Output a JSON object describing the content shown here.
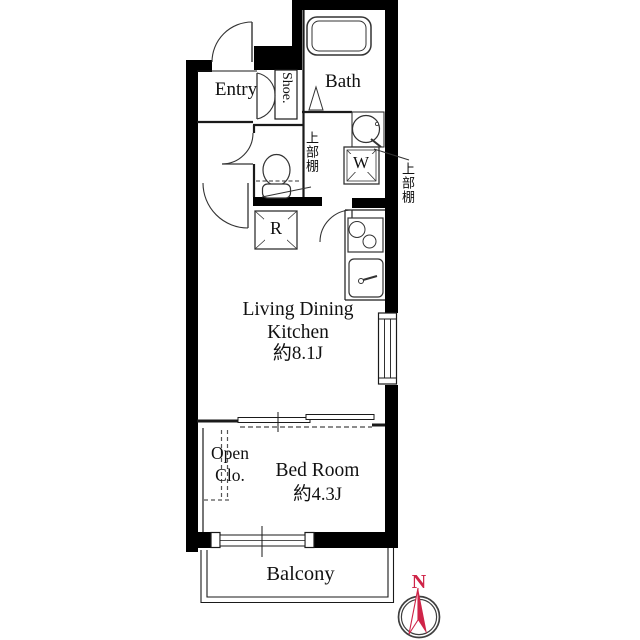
{
  "colors": {
    "wall": "#000000",
    "line": "#1a1a1a",
    "accent_red": "#cf2448"
  },
  "rooms": {
    "entry": {
      "label": "Entry"
    },
    "bath": {
      "label": "Bath"
    },
    "shoe": {
      "label": "Shoe."
    },
    "ldk": {
      "line1": "Living Dining",
      "line2": "Kitchen",
      "area": "約8.1J"
    },
    "open_closet": {
      "line1": "Open",
      "line2": "Clo."
    },
    "bedroom": {
      "label": "Bed Room",
      "area": "約4.3J"
    },
    "balcony": {
      "label": "Balcony"
    }
  },
  "fixtures": {
    "washer": {
      "label": "W"
    },
    "refrigerator": {
      "label": "R"
    },
    "upper_shelf_toilet": {
      "label": "上部棚"
    },
    "upper_shelf_washer": {
      "label": "上部棚"
    }
  },
  "compass": {
    "north_label": "N"
  }
}
